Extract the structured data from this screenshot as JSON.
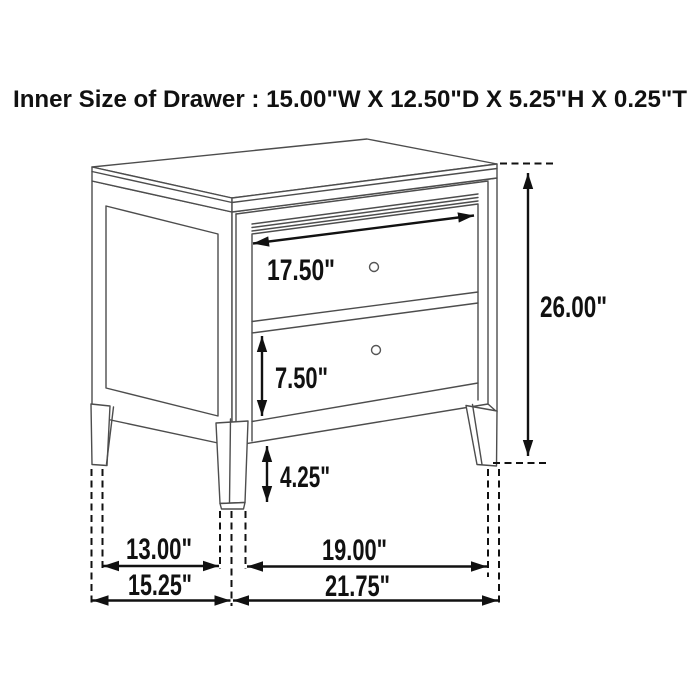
{
  "header": {
    "title": "Inner Size of Drawer : 15.00\"W X 12.50\"D X 5.25\"H X 0.25\"T"
  },
  "dimensions": {
    "drawer_inner_width": "17.50\"",
    "bottom_drawer_height": "7.50\"",
    "leg_height": "4.25\"",
    "overall_height": "26.00\"",
    "side_leg_spacing": "13.00\"",
    "front_leg_spacing": "19.00\"",
    "overall_depth": "15.25\"",
    "overall_width": "21.75\""
  },
  "colors": {
    "drawing_line": "#4d4d4d",
    "dimension_line": "#111111",
    "background": "#ffffff"
  }
}
